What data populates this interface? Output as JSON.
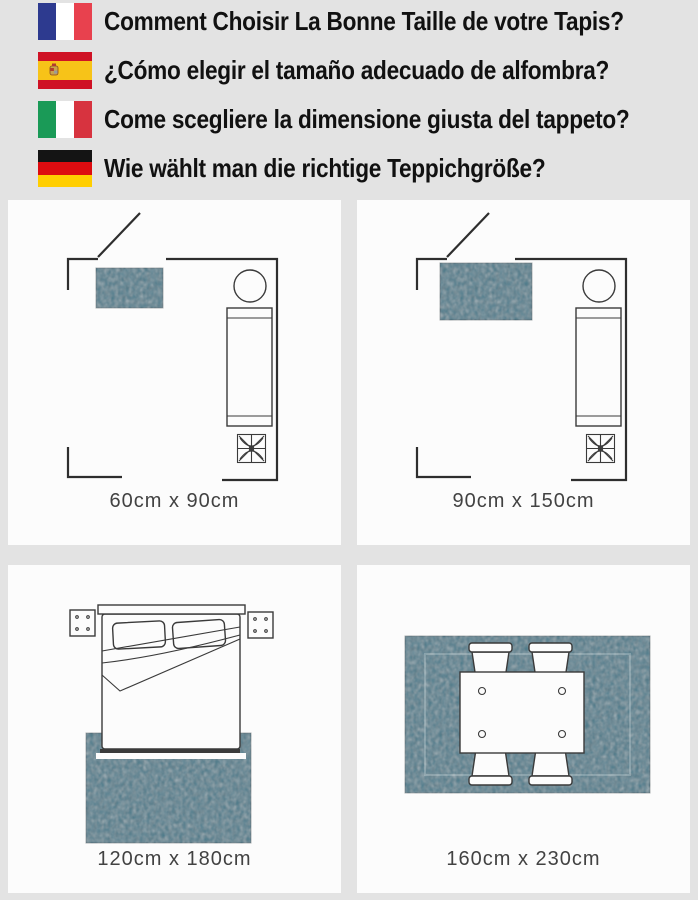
{
  "header": {
    "rows": [
      {
        "flag": "france",
        "text": "Comment Choisir La Bonne Taille de votre Tapis?"
      },
      {
        "flag": "spain",
        "text": "¿Cómo elegir el tamaño adecuado de alfombra?"
      },
      {
        "flag": "italy",
        "text": "Come scegliere la dimensione giusta del tappeto?"
      },
      {
        "flag": "germany",
        "text": "Wie wählt man die richtige Teppichgröße?"
      }
    ]
  },
  "panels": [
    {
      "scene": "entryway floor plan with small rug",
      "label": "60cm x 90cm"
    },
    {
      "scene": "entryway floor plan with larger rug",
      "label": "90cm x 150cm"
    },
    {
      "scene": "bedroom, rug under lower half of bed",
      "label": "120cm x 180cm"
    },
    {
      "scene": "dining table and four chairs on rug",
      "label": "160cm x 230cm"
    }
  ],
  "colors": {
    "page_bg": "#e3e3e3",
    "panel_bg": "#fcfcfc",
    "line": "#2e2e2e",
    "label_text": "#424242",
    "rug_teal": "#44798a",
    "fr_blue": "#2d3a8f",
    "fr_red": "#e8414e",
    "es_red": "#cf1225",
    "es_yellow": "#f7c318",
    "it_green": "#1a9a57",
    "it_red": "#d7333f",
    "de_black": "#141414",
    "de_red": "#dd0c10",
    "de_gold": "#ffce00"
  }
}
